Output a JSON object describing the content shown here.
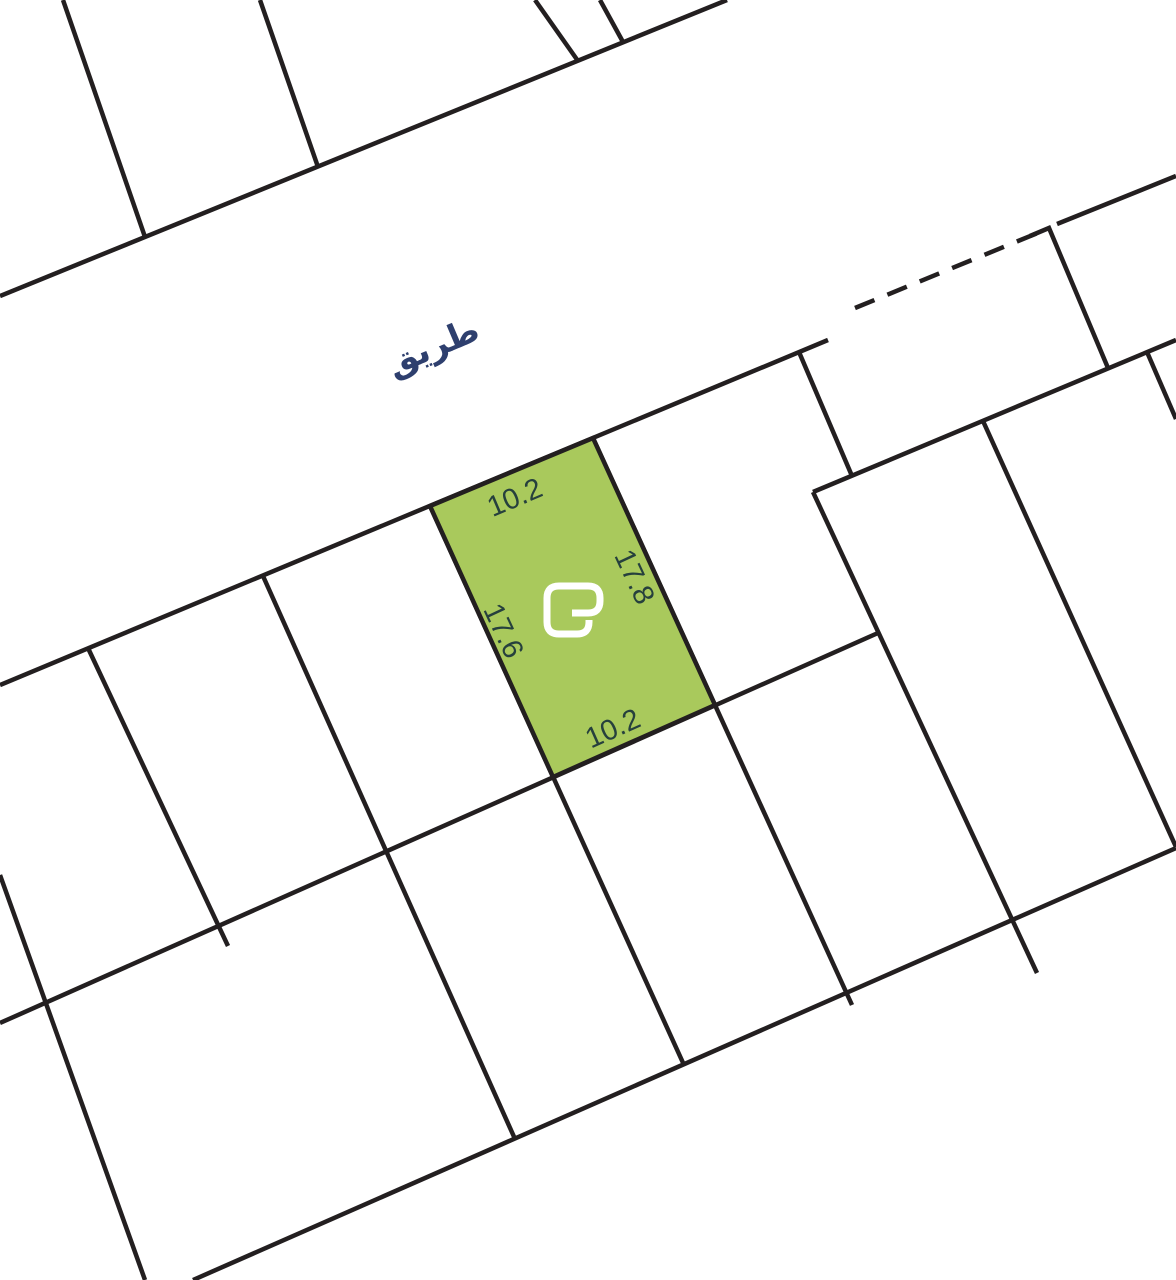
{
  "map": {
    "road_label": "طريق",
    "highlighted_parcel": {
      "dim_top": "10.2",
      "dim_right": "17.8",
      "dim_left": "17.6",
      "dim_bottom": "10.2",
      "fill": "#a9c95c"
    },
    "colors": {
      "boundary_line": "#231f20",
      "dimension_text": "#26403d",
      "road_text": "#2e3f6e",
      "logo": "#ffffff",
      "background": "#ffffff"
    },
    "icons": {
      "parcel_logo": "brand-g-logo"
    }
  }
}
